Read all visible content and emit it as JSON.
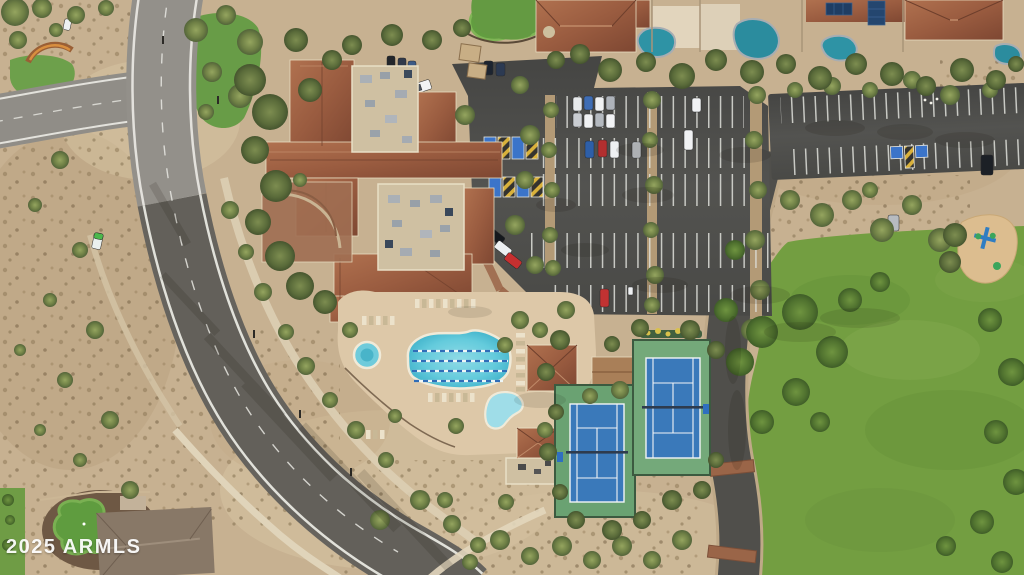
{
  "watermark": {
    "text": "2025 ARMLS"
  },
  "palette": {
    "desert": "#c7b191",
    "asphalt_road": "#66635d",
    "concrete_road": "#93908a",
    "parking_asphalt": "#4e4e4b",
    "terracotta_roof": "#9a5c40",
    "flat_roof": "#cfc0a2",
    "pool_water": "#64cbdc",
    "lane_rope_blue": "#2f6db8",
    "tennis_court_blue": "#3a79ba",
    "tennis_apron_green": "#6aa272",
    "grass_field": "#739e41",
    "tree_olive": "#6e7f45",
    "stall_line_white": "#dedfda",
    "accessible_yellow": "#d9b13b",
    "accessible_blue": "#3b74c9",
    "brick_paving": "#9a6548"
  },
  "features": {
    "road": "community-road",
    "clubhouse": "clubhouse-roofs",
    "pool": "lap-pool",
    "spa": "round-spa",
    "kids_pool": "wading-pool",
    "tennis": "tennis-courts",
    "parking": "parking-lots",
    "field": "grass-field",
    "playground": "playground",
    "homes": "residential-homes",
    "putting_green": "putting-green"
  }
}
